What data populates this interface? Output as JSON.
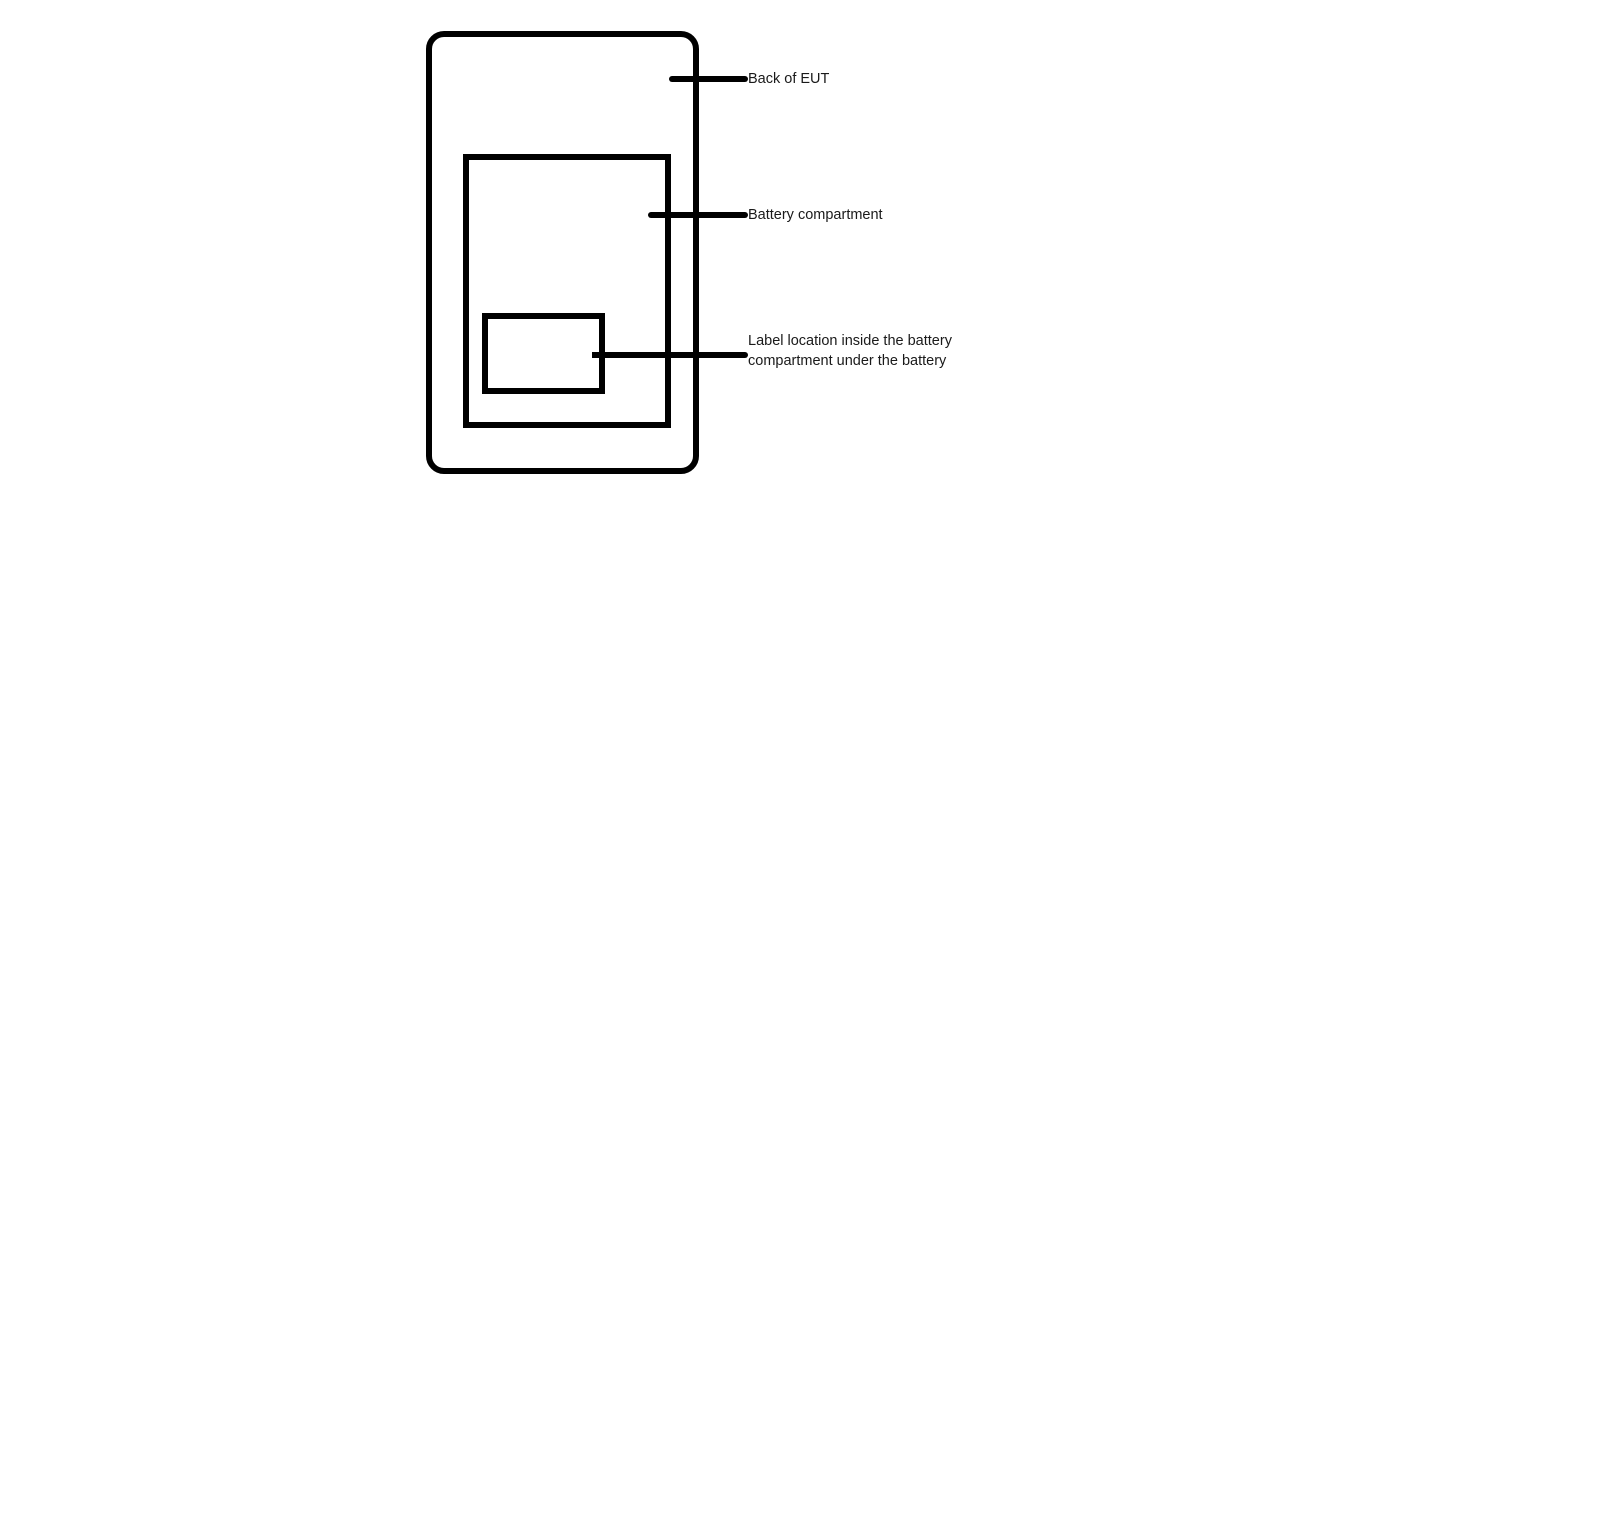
{
  "diagram": {
    "background_color": "#ffffff",
    "stroke_color": "#000000",
    "text_color": "#1a1a1a",
    "shapes": [
      {
        "name": "device-back-outline",
        "description": "rounded rectangle"
      },
      {
        "name": "battery-compartment-outline",
        "description": "rectangle"
      },
      {
        "name": "label-location-outline",
        "description": "small rectangle"
      }
    ],
    "annotations": {
      "back_of_eut": {
        "label": "Back of EUT"
      },
      "battery_compartment": {
        "label": "Battery compartment"
      },
      "label_location": {
        "line1": "Label location inside the battery",
        "line2": "compartment under the battery"
      }
    }
  }
}
